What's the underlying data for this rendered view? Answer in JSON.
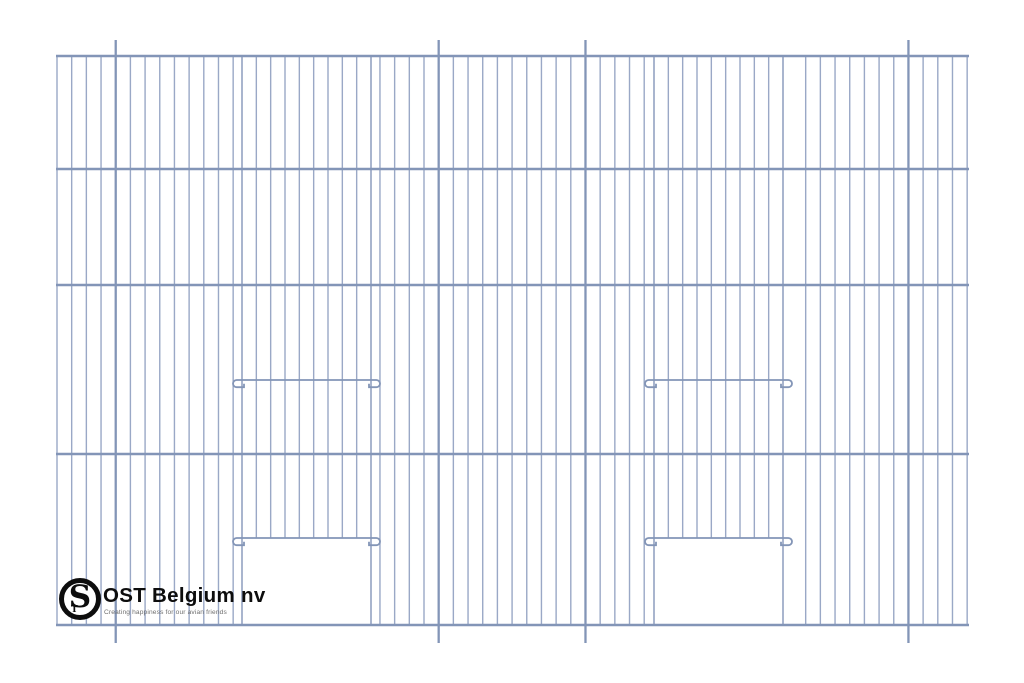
{
  "page": {
    "title": ""
  },
  "brand": {
    "name": "OST Belgium nv",
    "tagline": "Creating happiness for our avian friends",
    "monogram_large": "S",
    "monogram_small": "T",
    "ring_color": "#0d0d0d",
    "name_color": "#0d0d0d",
    "tagline_color": "#6f6f6f"
  },
  "drawing": {
    "description": "wire-mesh bird cage front panel with two sliding doors",
    "background_color": "#ffffff",
    "wire_color": "#9aa8c6",
    "frame_color": "#8395b7",
    "canvas": {
      "width": 1024,
      "height": 683
    },
    "panel": {
      "x_left": 57,
      "x_right": 967,
      "y_top": 56,
      "y_bottom": 625
    },
    "horizontal_bars_y": [
      56,
      169,
      285,
      454,
      625
    ],
    "vertical_wires": {
      "count": 63,
      "pitch": 14.68
    },
    "mounting_pins": {
      "wire_indices": [
        4,
        26,
        36,
        58
      ],
      "y_top": 40,
      "y_bottom": 643
    },
    "doors": [
      {
        "name": "left-door",
        "x_left": 242,
        "x_right": 371,
        "wire_count": 10,
        "upper_rail_y": 380,
        "lower_rail_y": 538,
        "hook_overhang": 9
      },
      {
        "name": "right-door",
        "x_left": 654,
        "x_right": 783,
        "wire_count": 10,
        "upper_rail_y": 380,
        "lower_rail_y": 538,
        "hook_overhang": 9
      }
    ],
    "line_widths": {
      "wire": 1.4,
      "door_edge": 1.7,
      "door_wire": 1.4,
      "bar": 2.4,
      "pin": 2.3,
      "rail": 1.8
    }
  }
}
